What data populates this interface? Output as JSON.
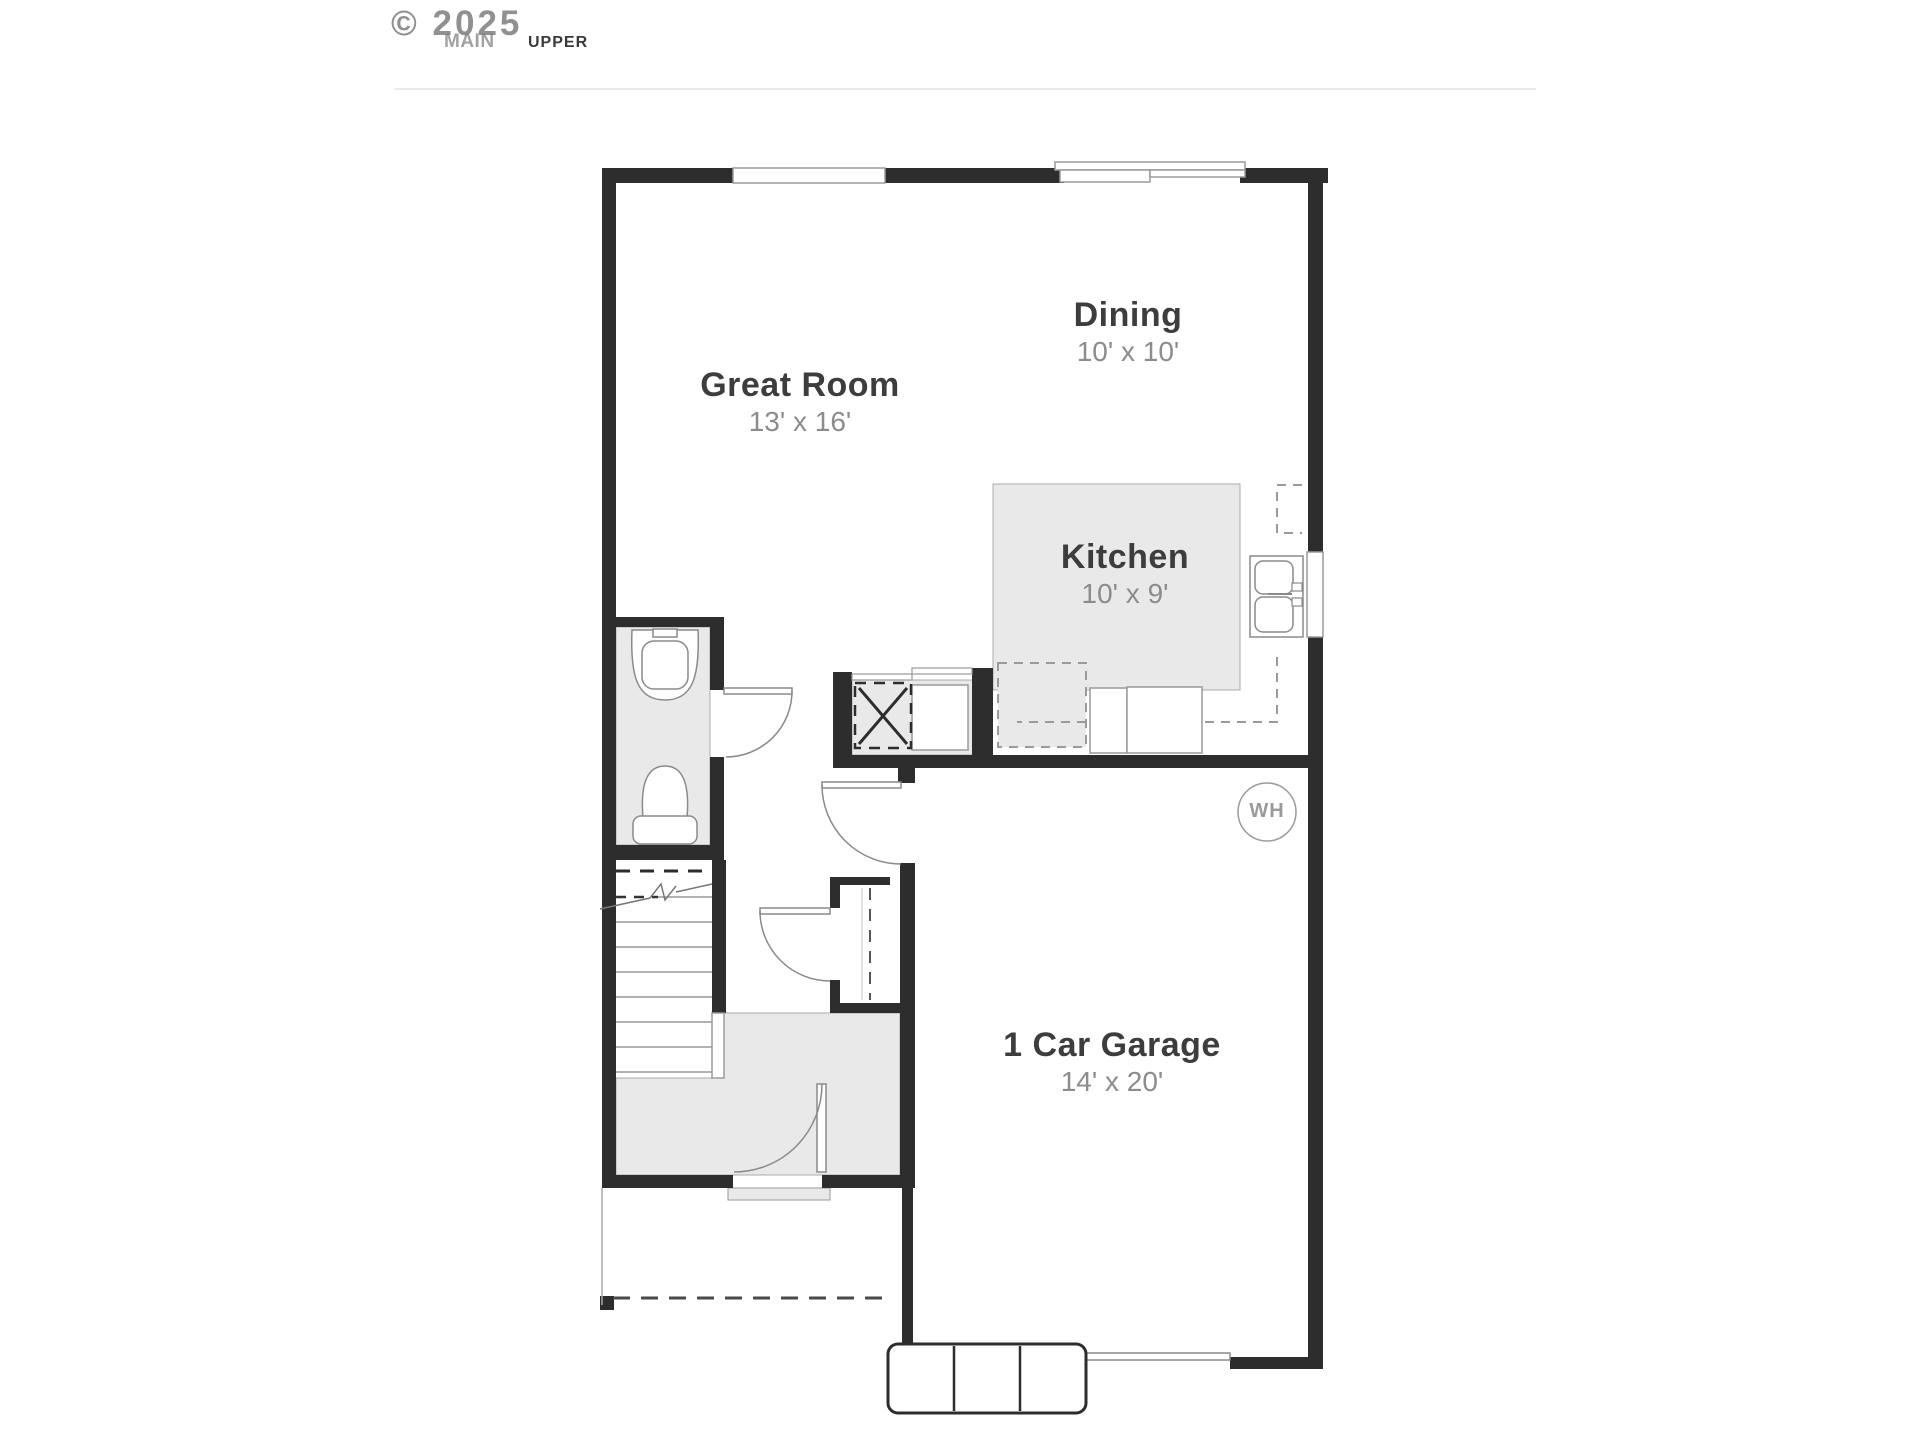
{
  "header": {
    "watermark": "© 2025",
    "tabs": {
      "main": "MAIN",
      "upper": "UPPER"
    }
  },
  "rooms": {
    "dining": {
      "name": "Dining",
      "dims": "10' x 10'"
    },
    "great_room": {
      "name": "Great Room",
      "dims": "13' x 16'"
    },
    "kitchen": {
      "name": "Kitchen",
      "dims": "10' x 9'"
    },
    "garage": {
      "name": "1 Car Garage",
      "dims": "14' x 20'"
    }
  },
  "labels": {
    "water_heater": "WH"
  },
  "colors": {
    "wall": "#2d2d2d",
    "floor_gray": "#e9e9ea",
    "thin_line": "#9a9a9a",
    "room_name_text": "#3d3d3d",
    "room_dims_text": "#8c8c8c",
    "tab_inactive": "#a2a2a2",
    "tab_active": "#3a3a3a",
    "divider": "#e9e9e9"
  }
}
